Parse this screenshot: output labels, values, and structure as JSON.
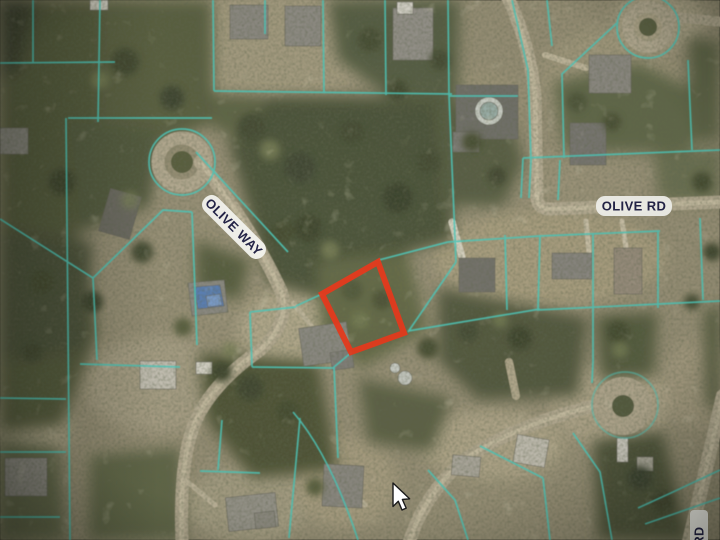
{
  "window": {
    "width": 720,
    "height": 540,
    "kind": "aerial-parcel-map-view"
  },
  "map": {
    "description": "aerial photo with GIS parcel overlay and highlighted lot",
    "labels": {
      "olive_way": "OLIVE WAY",
      "olive_rd": "OLIVE RD",
      "rd_partial": "RD"
    },
    "colors": {
      "parcel_line": "#4fc8ba",
      "highlight_parcel": "#e8391c",
      "label_text": "#232347",
      "label_bg": "#f6f5f0"
    },
    "cursor_icon": "arrow-pointer"
  }
}
